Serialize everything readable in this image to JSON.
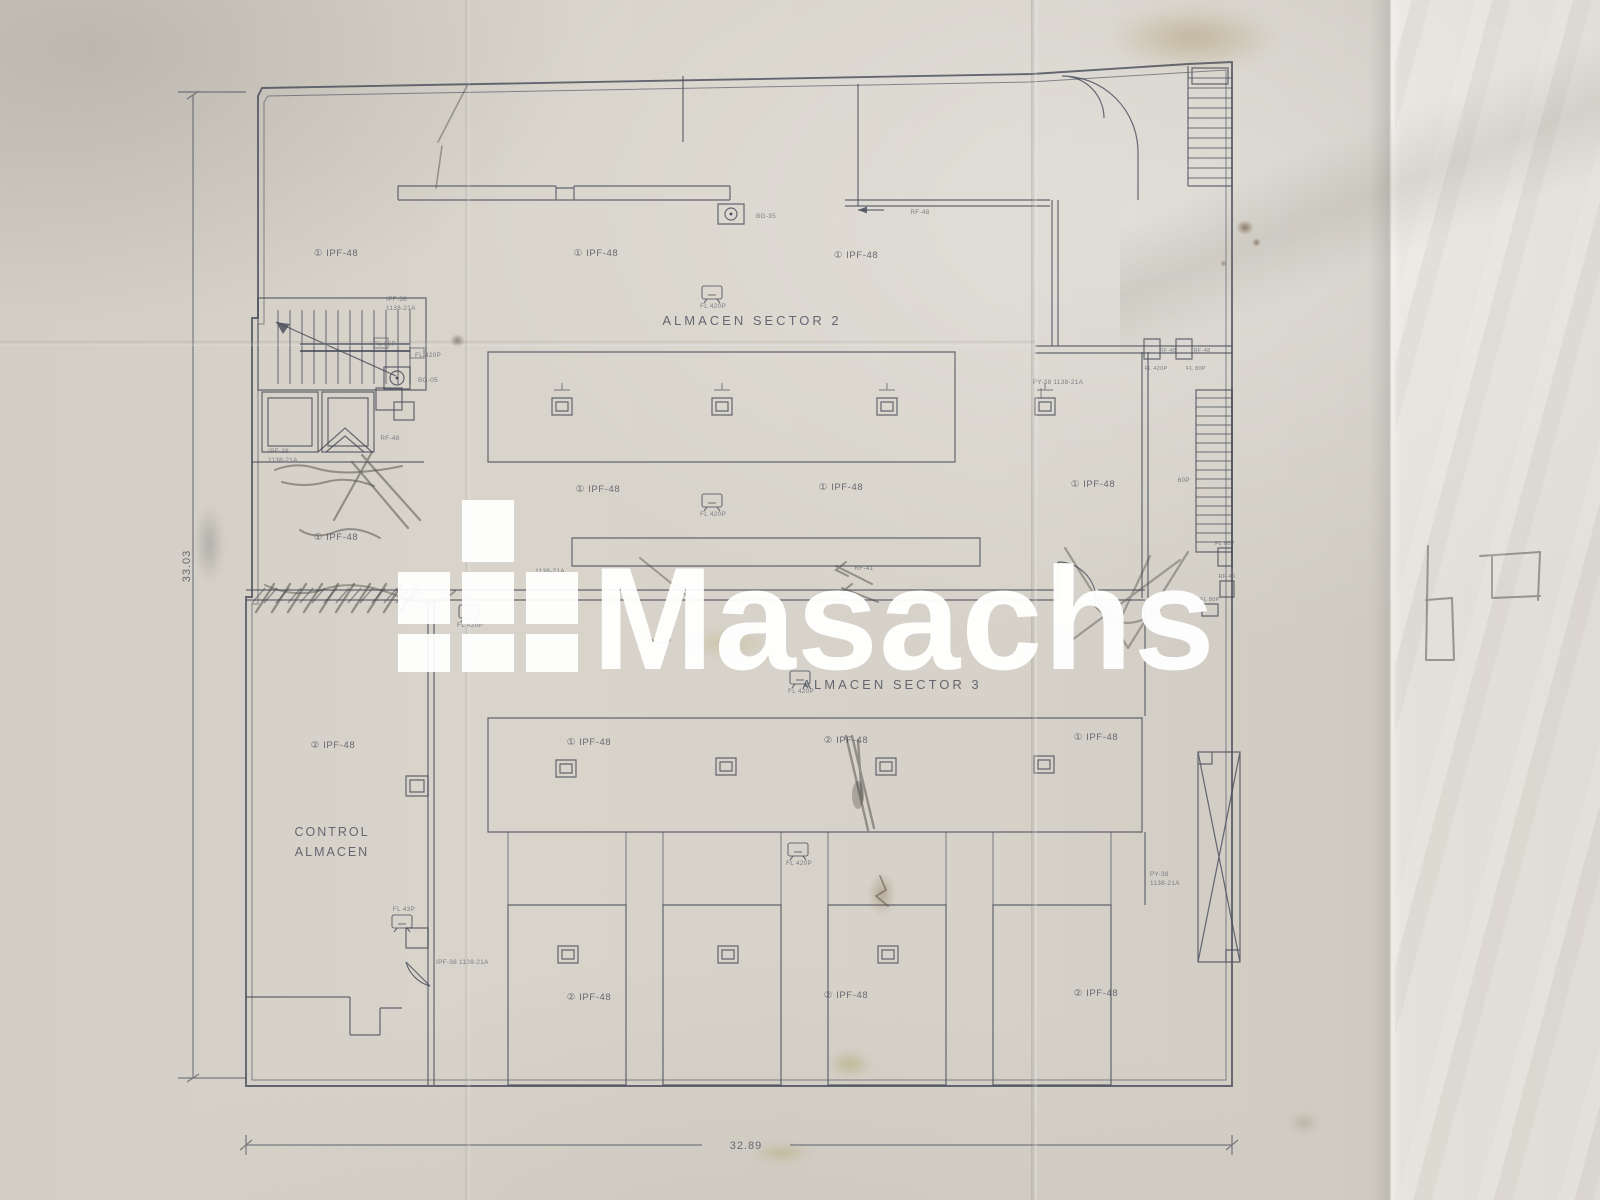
{
  "watermark": {
    "text": "Masachs"
  },
  "titles": {
    "sector2": "ALMACEN SECTOR 2",
    "sector3": "ALMACEN SECTOR 3",
    "control_line1": "CONTROL",
    "control_line2": "ALMACEN"
  },
  "dimensions": {
    "left_height": "33.03",
    "bottom_width": "32.89"
  },
  "equipment": {
    "ipf48_c1": "① IPF-48",
    "ipf48_c2": "② IPF-48",
    "fl420p": "FL 420P",
    "fl80p": "FL 80P",
    "fl43p": "FL 43P",
    "fl60p": "60P",
    "bg35": "BG-35",
    "bg05": "BG-05",
    "rf48": "RF-48",
    "rf41": "RF-41",
    "rf46": "RF-46",
    "ipf38": "IPF-38",
    "py38": "PY-38",
    "code1138": "1138-21A",
    "ipf38_inline": "IPF-38 1138-21A",
    "py38_inline": "PY-38 1138-21A"
  }
}
